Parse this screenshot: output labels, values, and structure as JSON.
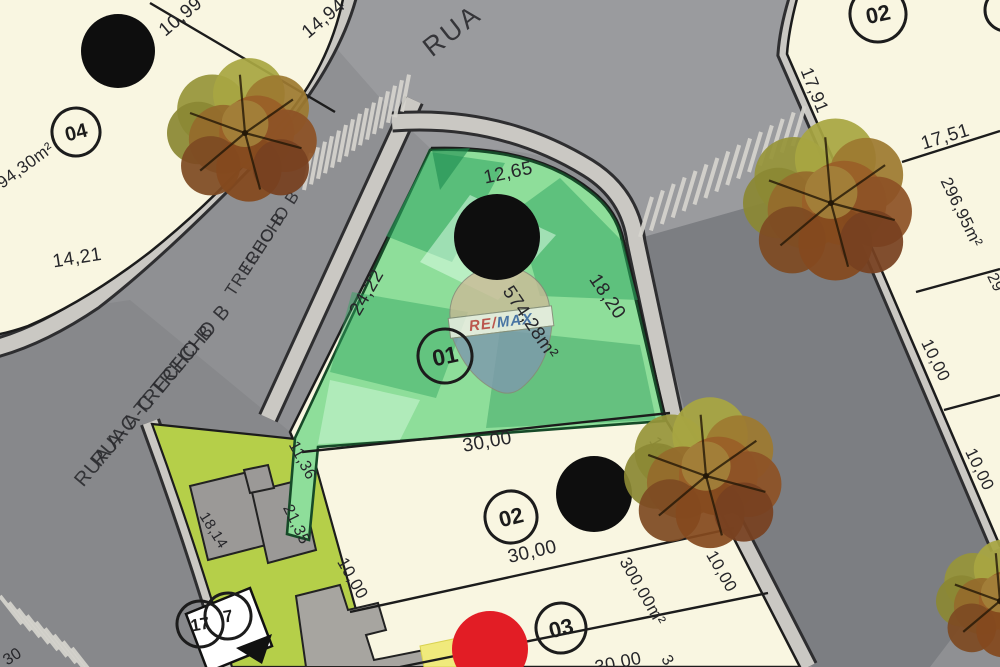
{
  "map": {
    "description": "Loteamento site plan with highlighted corner lot",
    "watermark": {
      "re": "RE",
      "slash": "/",
      "max": "MAX"
    },
    "streets": [
      {
        "name": "RUA",
        "x": 452,
        "y": 30,
        "rot": -38,
        "fs": 27,
        "ls": 3,
        "double": false
      },
      {
        "name": "TRECHO B",
        "x": 262,
        "y": 243,
        "rot": -57,
        "fs": 17,
        "ls": 1,
        "double": true
      },
      {
        "name": "RUA A-C TRECHO B",
        "x": 152,
        "y": 395,
        "rot": -50,
        "fs": 20,
        "ls": 1,
        "double": true
      }
    ],
    "measurements": [
      {
        "text": "10,99",
        "x": 180,
        "y": 16,
        "rot": -40,
        "fs": 19
      },
      {
        "text": "14,94",
        "x": 323,
        "y": 18,
        "rot": -40,
        "fs": 19
      },
      {
        "text": "94,30m²",
        "x": 25,
        "y": 165,
        "rot": -36,
        "fs": 17
      },
      {
        "text": "14,21",
        "x": 77,
        "y": 257,
        "rot": -9,
        "fs": 19
      },
      {
        "text": "12,65",
        "x": 508,
        "y": 172,
        "rot": -12,
        "fs": 19
      },
      {
        "text": "24,22",
        "x": 366,
        "y": 292,
        "rot": -60,
        "fs": 19
      },
      {
        "text": "18,20",
        "x": 608,
        "y": 296,
        "rot": 56,
        "fs": 19
      },
      {
        "text": "574,28m²",
        "x": 531,
        "y": 322,
        "rot": 56,
        "fs": 19
      },
      {
        "text": "30,00",
        "x": 487,
        "y": 441,
        "rot": -10,
        "fs": 19
      },
      {
        "text": "11,36",
        "x": 303,
        "y": 460,
        "rot": 62,
        "fs": 16
      },
      {
        "text": "21,35",
        "x": 297,
        "y": 524,
        "rot": 64,
        "fs": 16
      },
      {
        "text": "10,00",
        "x": 353,
        "y": 578,
        "rot": 60,
        "fs": 17
      },
      {
        "text": "30,00",
        "x": 532,
        "y": 551,
        "rot": -13,
        "fs": 19
      },
      {
        "text": "300,00m²",
        "x": 643,
        "y": 591,
        "rot": 60,
        "fs": 17
      },
      {
        "text": "10,00",
        "x": 665,
        "y": 457,
        "rot": 60,
        "fs": 17
      },
      {
        "text": "10,00",
        "x": 722,
        "y": 571,
        "rot": 60,
        "fs": 17
      },
      {
        "text": "30,00",
        "x": 618,
        "y": 662,
        "rot": -12,
        "fs": 18
      },
      {
        "text": "3",
        "x": 668,
        "y": 660,
        "rot": 60,
        "fs": 16
      },
      {
        "text": "18,14",
        "x": 214,
        "y": 530,
        "rot": 58,
        "fs": 15
      },
      {
        "text": "13",
        "x": 221,
        "y": 640,
        "rot": -24,
        "fs": 20
      },
      {
        "text": "30",
        "x": 12,
        "y": 656,
        "rot": -33,
        "fs": 16
      },
      {
        "text": "17,91",
        "x": 815,
        "y": 90,
        "rot": 68,
        "fs": 18
      },
      {
        "text": "17,51",
        "x": 945,
        "y": 136,
        "rot": -17,
        "fs": 19
      },
      {
        "text": "296,95m²",
        "x": 962,
        "y": 212,
        "rot": 64,
        "fs": 17
      },
      {
        "text": "10,00",
        "x": 936,
        "y": 360,
        "rot": 64,
        "fs": 17
      },
      {
        "text": "10,00",
        "x": 980,
        "y": 469,
        "rot": 64,
        "fs": 17
      },
      {
        "text": "29",
        "x": 996,
        "y": 282,
        "rot": 64,
        "fs": 16
      }
    ],
    "lot_markers": [
      {
        "label": "04",
        "cx": 76,
        "cy": 132,
        "r": 24,
        "fs": 20,
        "rot": -14
      },
      {
        "label": "01",
        "cx": 445,
        "cy": 356,
        "r": 27,
        "fs": 23,
        "rot": -12
      },
      {
        "label": "02",
        "cx": 511,
        "cy": 517,
        "r": 26,
        "fs": 22,
        "rot": -14
      },
      {
        "label": "03",
        "cx": 561,
        "cy": 628,
        "r": 25,
        "fs": 22,
        "rot": -14
      },
      {
        "label": "02",
        "cx": 878,
        "cy": 14,
        "r": 28,
        "fs": 22,
        "rot": -12
      },
      {
        "label": "17",
        "cx": 200,
        "cy": 624,
        "r": 23,
        "fs": 17,
        "rot": -10
      },
      {
        "label": "7",
        "cx": 228,
        "cy": 616,
        "r": 23,
        "fs": 17,
        "rot": -10
      },
      {
        "label": "",
        "cx": 1006,
        "cy": 10,
        "r": 21,
        "fs": 18,
        "rot": 0
      }
    ],
    "survey_dots": [
      {
        "cx": 118,
        "cy": 51,
        "r": 37,
        "color": "black"
      },
      {
        "cx": 497,
        "cy": 237,
        "r": 43,
        "color": "black"
      },
      {
        "cx": 594,
        "cy": 494,
        "r": 38,
        "color": "black"
      },
      {
        "cx": 490,
        "cy": 649,
        "r": 38,
        "color": "red"
      }
    ],
    "trees": [
      {
        "cx": 245,
        "cy": 133,
        "r": 78
      },
      {
        "cx": 831,
        "cy": 203,
        "r": 88
      },
      {
        "cx": 706,
        "cy": 476,
        "r": 82
      },
      {
        "cx": 1000,
        "cy": 601,
        "r": 64
      }
    ],
    "colors": {
      "road": "#8f9093",
      "road_top": "#9a9b9e",
      "road_right": "#7c7e82",
      "road_junction": "#87888b",
      "sidewalk": "#cac8c3",
      "sidewalk_edge": "#2e2e30",
      "lot_fill": "#f9f6e1",
      "line": "#1c1c1c",
      "highlight_fill": "#8ede9a",
      "highlight_edge": "#164a28",
      "park_fill": "#b5cf49",
      "building": "#9b9997",
      "connector": "#a7a5a0",
      "white_sign": "#ffffff",
      "yellow": "#f0ea7c",
      "crosswalk": "#d6d4ce",
      "dot_black": "#0e0e0e",
      "dot_red": "#e21d25",
      "text": "#26262a",
      "remax_red": "#c63a3e",
      "remax_blue": "#3a5fa7",
      "balloon_top": "#c9bb97",
      "balloon_band": "#f2efe7",
      "balloon_bottom": "#7e99ad"
    }
  }
}
